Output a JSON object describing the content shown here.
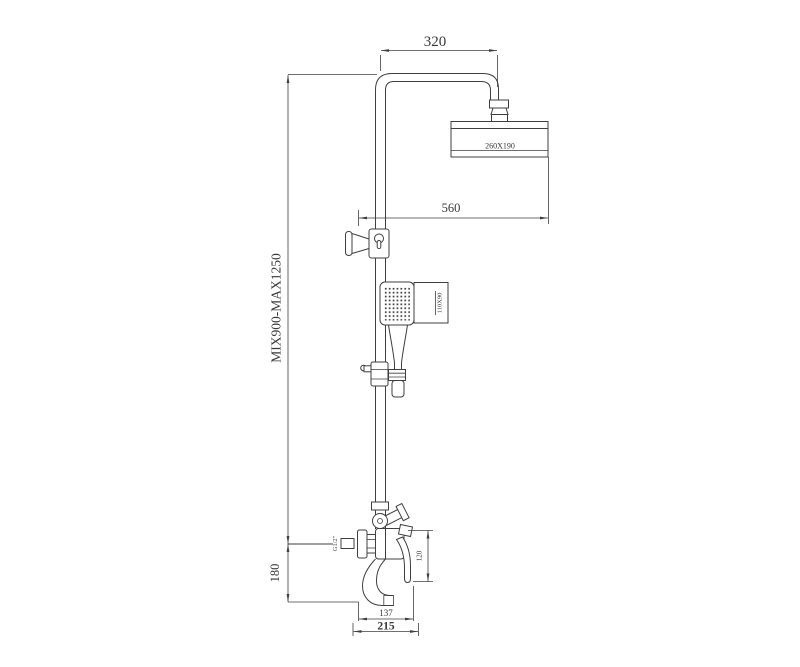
{
  "meta": {
    "background": "#ffffff",
    "ink_color": "#3f3f3f",
    "drawing_type": "shower-column-technical-drawing"
  },
  "labels": {
    "dim_arm_offset": "320",
    "dim_head_size": "260X190",
    "dim_head_drop": "560",
    "dim_height_range": "MIX900-MAX1250",
    "dim_inlet_height": "180",
    "dim_handshower_size": "110X90",
    "dim_thread": "G1/2\"",
    "dim_handle_height": "120",
    "dim_spout_reach": "137",
    "dim_body_width": "215"
  }
}
